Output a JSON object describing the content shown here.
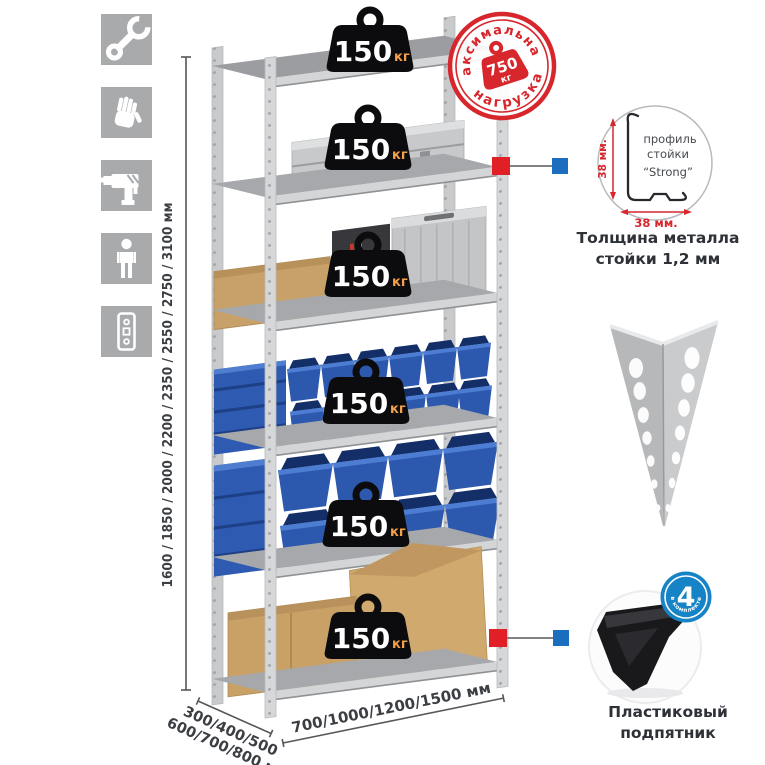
{
  "colors": {
    "stamp_red": "#d7262c",
    "connector_red": "#e01f26",
    "connector_blue": "#1b6dbe",
    "bin_blue": "#2c58ae",
    "badge_blue": "#1583c5",
    "badge_black": "#0c0c0e",
    "kg_orange": "#f5a04b",
    "metal_gray": "#d6d7d9",
    "cardboard": "#c9a166"
  },
  "sidebar": {
    "icons": [
      "wrench-icon",
      "gloves-icon",
      "drill-icon",
      "person-icon",
      "post-profile-icon"
    ]
  },
  "dimensions": {
    "height": "1600 / 1850 / 2000 / 2200 / 2350 / 2550 / 2750 / 3100 мм",
    "depth_line1": "300/400/500",
    "depth_line2": "600/700/800 мм",
    "width": "700/1000/1200/1500 мм"
  },
  "load_badges": [
    {
      "value": "150",
      "unit": "кг"
    },
    {
      "value": "150",
      "unit": "кг"
    },
    {
      "value": "150",
      "unit": "кг"
    },
    {
      "value": "150",
      "unit": "кг"
    },
    {
      "value": "150",
      "unit": "кг"
    },
    {
      "value": "150",
      "unit": "кг"
    }
  ],
  "stamp": {
    "arc_top": "максимальная",
    "arc_bottom": "нагрузка",
    "value": "750",
    "unit": "кг"
  },
  "profile_callout": {
    "label1": "профиль",
    "label2": "стойки",
    "label3": "“Strong”",
    "dim_vertical": "38 мм.",
    "dim_horizontal": "38 мм.",
    "caption1": "Толщина металла",
    "caption2": "стойки 1,2 мм"
  },
  "foot_callout": {
    "count": "4",
    "arc_text": "в комплекте",
    "caption1": "Пластиковый",
    "caption2": "подпятник"
  }
}
